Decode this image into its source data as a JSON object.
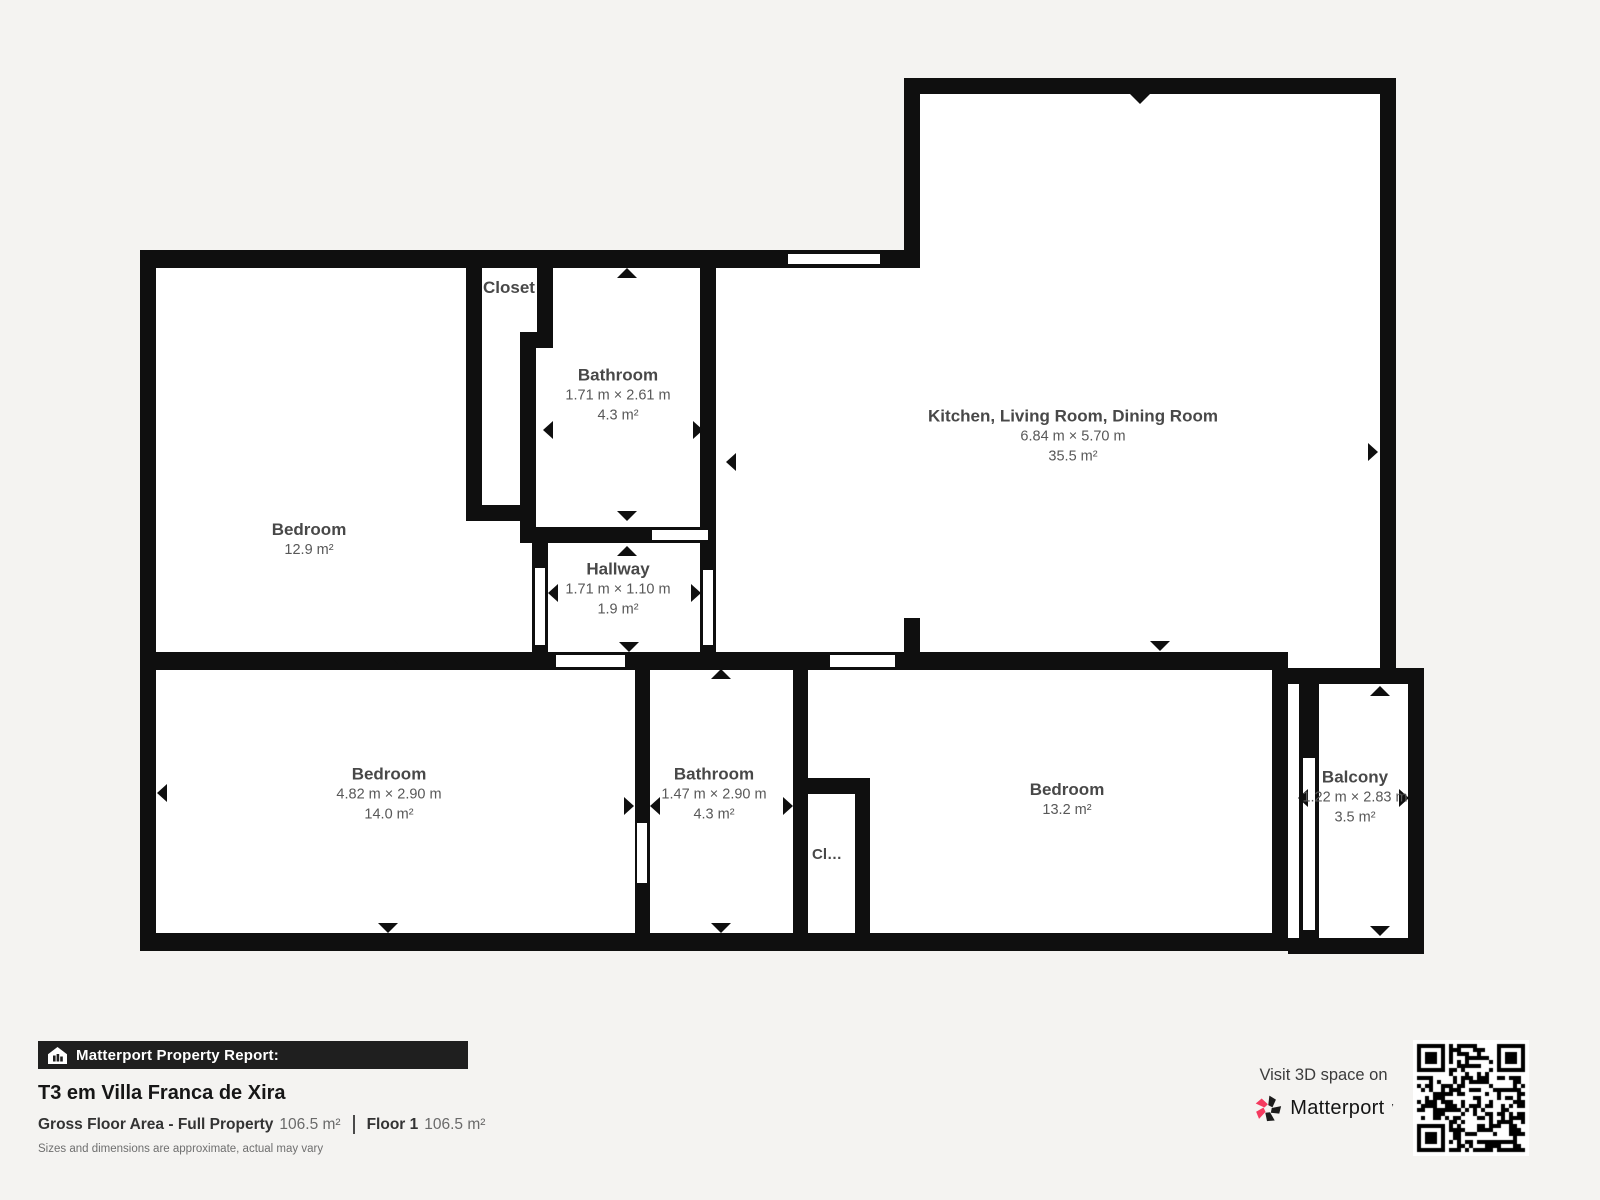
{
  "colors": {
    "background": "#f4f3f1",
    "wall": "#0f0f0f",
    "room_fill": "#ffffff",
    "label_text": "#4b4b4b",
    "footer_bar": "#1f1f1f",
    "brand_pink": "#f43a5f",
    "brand_black": "#1c1c1c"
  },
  "rooms": {
    "bedroom_tl": {
      "name": "Bedroom",
      "area": "12.9 m²"
    },
    "closet_top": {
      "name": "Closet"
    },
    "bathroom_top": {
      "name": "Bathroom",
      "dimensions": "1.71 m × 2.61 m",
      "area": "4.3 m²"
    },
    "kitchen": {
      "name": "Kitchen, Living Room, Dining Room",
      "dimensions": "6.84 m × 5.70 m",
      "area": "35.5 m²"
    },
    "hallway": {
      "name": "Hallway",
      "dimensions": "1.71 m × 1.10 m",
      "area": "1.9 m²"
    },
    "bedroom_bl": {
      "name": "Bedroom",
      "dimensions": "4.82 m × 2.90 m",
      "area": "14.0 m²"
    },
    "bathroom_bottom": {
      "name": "Bathroom",
      "dimensions": "1.47 m × 2.90 m",
      "area": "4.3 m²"
    },
    "closet_bottom": {
      "name": "Cl…"
    },
    "bedroom_br": {
      "name": "Bedroom",
      "area": "13.2 m²"
    },
    "balcony": {
      "name": "Balcony",
      "dimensions": "1.22 m × 2.83 m",
      "area": "3.5 m²"
    }
  },
  "footer": {
    "report_label": "Matterport Property Report:",
    "title": "T3 em Villa Franca de Xira",
    "gross_floor_label": "Gross Floor Area - Full Property",
    "gross_floor_value": "106.5 m²",
    "floor_label": "Floor 1",
    "floor_value": "106.5 m²",
    "disclaimer": "Sizes and dimensions are approximate, actual may vary"
  },
  "promo": {
    "visit_text": "Visit 3D space on",
    "brand": "Matterport",
    "brand_mark": "’"
  }
}
